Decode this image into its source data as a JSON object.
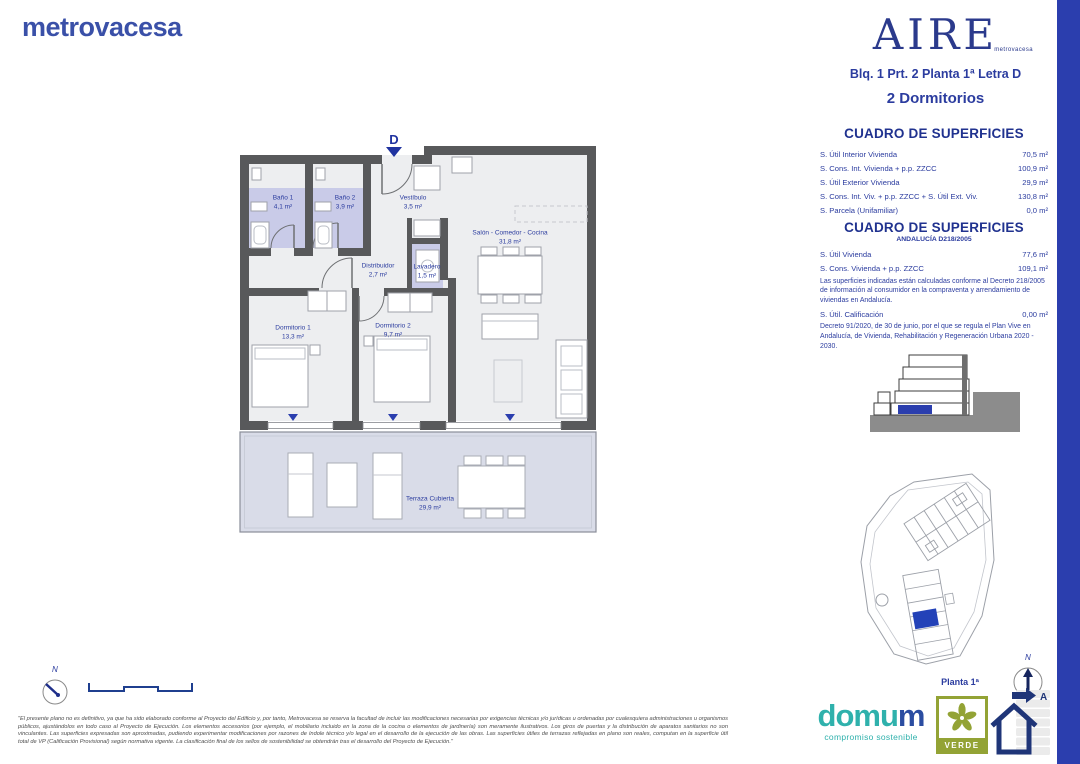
{
  "brand": {
    "name": "metrovacesa"
  },
  "aire": {
    "word": "AIRE",
    "sub": "metrovacesa"
  },
  "header": {
    "unit_ref": "Blq. 1 Prt. 2 Planta 1ª Letra D",
    "bedrooms": "2 Dormitorios"
  },
  "table1": {
    "title": "CUADRO DE SUPERFICIES",
    "rows": [
      {
        "label": "S. Útil Interior Vivienda",
        "value": "70,5 m²"
      },
      {
        "label": "S. Cons. Int. Vivienda + p.p. ZZCC",
        "value": "100,9 m²"
      },
      {
        "label": "S. Útil Exterior Vivienda",
        "value": "29,9 m²"
      },
      {
        "label": "S. Cons. Int. Viv. + p.p. ZZCC + S. Útil Ext. Viv.",
        "value": "130,8 m²"
      },
      {
        "label": "S. Parcela (Unifamiliar)",
        "value": "0,0 m²"
      }
    ]
  },
  "table2": {
    "title": "CUADRO DE SUPERFICIES",
    "subtitle": "ANDALUCÍA D218/2005",
    "rows": [
      {
        "label": "S. Útil Vivienda",
        "value": "77,6 m²"
      },
      {
        "label": "S. Cons. Vivienda + p.p. ZZCC",
        "value": "109,1 m²"
      }
    ],
    "note1": "Las superficies indicadas están calculadas conforme al Decreto 218/2005 de información al consumidor en la compraventa y arrendamiento de viviendas en Andalucía.",
    "row_calificacion": {
      "label": "S. Útil. Calificación",
      "value": "0,00 m²"
    },
    "note2": "Decreto 91/2020, de 30 de junio, por el que se regula el Plan Vive en Andalucía, de Vivienda, Rehabilitación y Regeneración Urbana 2020 - 2030."
  },
  "floorplan": {
    "unit_letter": "D",
    "rooms": [
      {
        "name": "Baño 1",
        "area": "4,1 m²"
      },
      {
        "name": "Baño 2",
        "area": "3,9 m²"
      },
      {
        "name": "Vestíbulo",
        "area": "3,5 m²"
      },
      {
        "name": "Salón - Comedor - Cocina",
        "area": "31,8 m²"
      },
      {
        "name": "Distribuidor",
        "area": "2,7 m²"
      },
      {
        "name": "Lavadero",
        "area": "1,5 m²"
      },
      {
        "name": "Dormitorio 1",
        "area": "13,3 m²"
      },
      {
        "name": "Dormitorio 2",
        "area": "9,7 m²"
      },
      {
        "name": "Terraza Cubierta",
        "area": "29,9 m²"
      }
    ]
  },
  "footer": {
    "planta": "Planta 1ª",
    "north": "N",
    "domum_part1": "domu",
    "domum_part2": "m",
    "domum_tagline": "compromiso sostenible",
    "verde": "VERDE",
    "energy_letter": "A",
    "disclaimer": "\"El presente plano no es definitivo, ya que ha sido elaborado conforme al Proyecto del Edificio y, por tanto, Metrovacesa se reserva la facultad de incluir las modificaciones necesarias por exigencias técnicas y/o jurídicas u ordenadas por cualesquiera administraciones u organismos públicos, ajustándolos en todo caso al Proyecto de Ejecución. Los elementos accesorios (por ejemplo, el mobiliario incluido en la zona de la cocina o elementos de jardinería) son meramente ilustrativos. Los giros de puertas y la distribución de aparatos sanitarios no son vinculantes. Las superficies expresadas son aproximadas, pudiendo experimentar modificaciones por razones de índole técnico y/o legal en el desarrollo de la ejecución de las obras. Las superficies útiles de terrazas reflejadas en plano son reales, computan en la superficie útil total de VP (Calificación Provisional) según normativa vigente. La clasificación final de los sellos de sostenibilidad se obtendrán tras el desarrollo del Proyecto de Ejecución.\""
  },
  "colors": {
    "accent_blue": "#2B3C9F",
    "brand_blue": "#3A50A8",
    "highlight_blue": "#2B3EAE",
    "wall_gray": "#58595B",
    "lavender": "#C9CBE8",
    "terrace_fill": "#D9DCE8",
    "domum_teal": "#2FB1AC",
    "verde_green": "#93A335"
  }
}
